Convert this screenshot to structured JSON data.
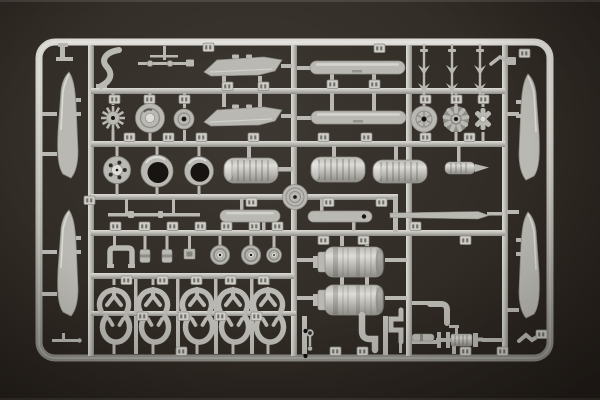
{
  "scene": {
    "type": "photograph",
    "subject": "light grey injection-molded plastic model kit sprue (parts runner) photographed on a dark brown surface",
    "sprue_material": "grey styrene",
    "background_surface": "dark charcoal-brown tabletop with soft vignette",
    "visible_text": "none legible (molded part-number tags are too small to read)"
  },
  "palette": {
    "background_dark": "#251f1a",
    "background_mid": "#332d27",
    "background_light": "#3e3832",
    "plastic_base": "#b9b8b2",
    "plastic_light": "#dedcd6",
    "plastic_shadow": "#8e8d87",
    "plastic_outline": "#6f6e69",
    "hole_dark": "#171411",
    "tab_face": "#cecdc7"
  },
  "parts_inventory": [
    {
      "name": "rotor-blade",
      "count": 4,
      "location": "two along left edge, two along right edge"
    },
    {
      "name": "hull-shaped-plate",
      "count": 2,
      "location": "upper left-center, stacked"
    },
    {
      "name": "skid-plate",
      "count": 2,
      "location": "upper center-right, stacked"
    },
    {
      "name": "dart-shaped-fitting",
      "count": 3,
      "location": "hanging from top rail, right"
    },
    {
      "name": "toothed-gear-wheel",
      "count": 1,
      "location": "row 2 left"
    },
    {
      "name": "ribbed-hub-disc",
      "count": 1,
      "location": "row 2"
    },
    {
      "name": "small-hub-disc",
      "count": 1,
      "location": "row 2"
    },
    {
      "name": "spiral-face-disc",
      "count": 1,
      "location": "row 2 right"
    },
    {
      "name": "radial-engine-face",
      "count": 1,
      "location": "row 2 right"
    },
    {
      "name": "cross-bracket",
      "count": 1,
      "location": "row 2 far right"
    },
    {
      "name": "spoked-wheel",
      "count": 1,
      "location": "row 3 left"
    },
    {
      "name": "open-cowl-ring",
      "count": 2,
      "location": "row 3 left"
    },
    {
      "name": "ribbed-cowling-cylinder",
      "count": 3,
      "location": "row 3 middle"
    },
    {
      "name": "center-hub-disc",
      "count": 1,
      "location": "center of sprue at runner crossing"
    },
    {
      "name": "ribbed-barrel-with-tip",
      "count": 1,
      "location": "row 3 right"
    },
    {
      "name": "thin-rod-strip",
      "count": 1,
      "location": "strip row left"
    },
    {
      "name": "pill-strip",
      "count": 2,
      "location": "strip row center"
    },
    {
      "name": "tapered-strip",
      "count": 1,
      "location": "strip row right"
    },
    {
      "name": "step-bracket",
      "count": 1,
      "location": "row 4 left"
    },
    {
      "name": "small-hub-cylinder",
      "count": 2,
      "location": "row 4"
    },
    {
      "name": "square-block",
      "count": 1,
      "location": "row 4"
    },
    {
      "name": "road-wheel",
      "count": 3,
      "location": "row 4"
    },
    {
      "name": "wheel-fork-horseshoe",
      "count": 5,
      "location": "row 5 upper"
    },
    {
      "name": "wheel-yoke-oval",
      "count": 5,
      "location": "row 5 lower"
    },
    {
      "name": "large-tank-cylinder",
      "count": 2,
      "location": "right-center, stacked"
    },
    {
      "name": "elbow-pipe",
      "count": 2,
      "location": "bottom center"
    },
    {
      "name": "zigzag-pipe",
      "count": 1,
      "location": "bottom center"
    },
    {
      "name": "short-pipe-segment",
      "count": 1,
      "location": "bottom center-right"
    },
    {
      "name": "chain-fitting",
      "count": 1,
      "location": "bottom center on runner"
    },
    {
      "name": "winch-drum-assembly",
      "count": 1,
      "location": "bottom right"
    },
    {
      "name": "pitot-tube",
      "count": 1,
      "location": "bottom left corner"
    },
    {
      "name": "angled-rod",
      "count": 1,
      "location": "bottom right between rails"
    },
    {
      "name": "curved-hook-part",
      "count": 1,
      "location": "top left"
    },
    {
      "name": "seat-bracket",
      "count": 1,
      "location": "top left corner"
    },
    {
      "name": "control-linkage",
      "count": 1,
      "location": "top left-center"
    },
    {
      "name": "clamp-fitting",
      "count": 1,
      "location": "top right inside corner"
    },
    {
      "name": "molded-part-number-tab",
      "count": "numerous",
      "location": "scattered on runners, digits illegible"
    },
    {
      "name": "ejector-hole",
      "count": 2,
      "location": "lower center runner, dark dots"
    }
  ]
}
